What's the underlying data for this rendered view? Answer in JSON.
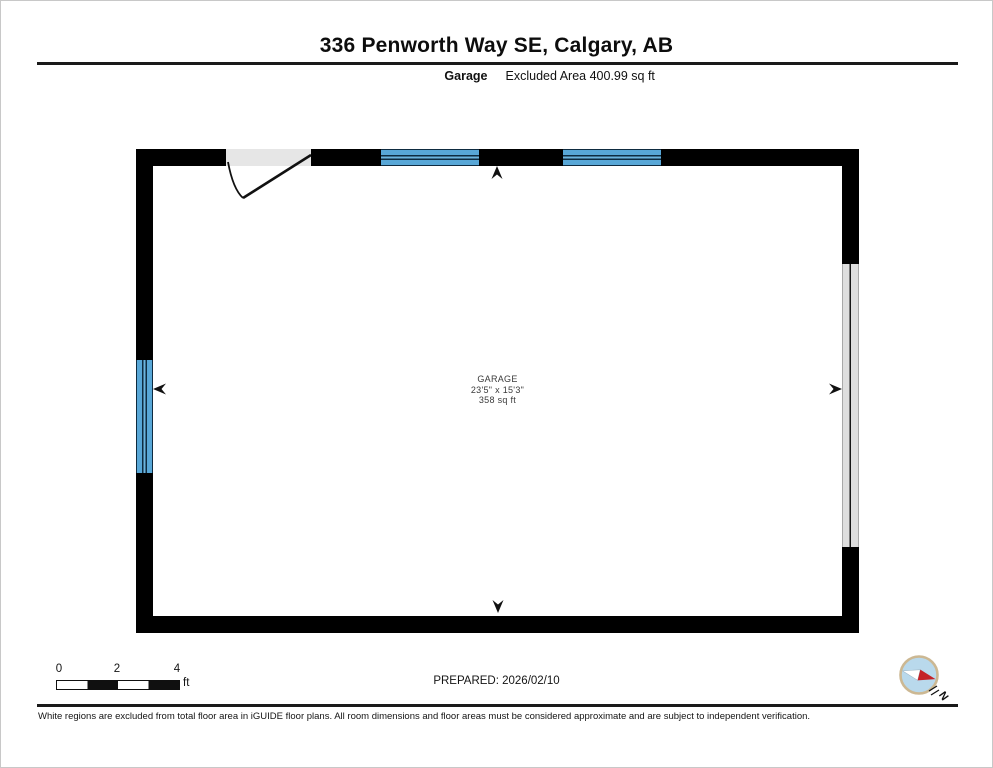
{
  "header": {
    "title": "336 Penworth Way SE, Calgary, AB",
    "floor_label": "Garage",
    "excluded_area": "Excluded Area 400.99 sq ft"
  },
  "floorplan": {
    "room": {
      "name": "GARAGE",
      "dimensions": "23'5\" x 15'3\"",
      "area": "358 sq ft"
    },
    "features": [
      "entry-door-swing",
      "window-top-left",
      "window-top-right",
      "window-left-wall",
      "garage-door-right-wall",
      "camera-arrow-up",
      "camera-arrow-down",
      "camera-arrow-left",
      "camera-arrow-right"
    ],
    "colors": {
      "wall": "#000000",
      "window_fill": "#58a7d7",
      "window_line": "#0e2b40",
      "door_opening_fill": "#e6e6e6",
      "garage_door_fill": "#dedede"
    }
  },
  "footer": {
    "scale": {
      "ticks": [
        "0",
        "2",
        "4"
      ],
      "unit": "ft"
    },
    "prepared": "PREPARED: 2026/02/10",
    "compass_north": "N",
    "disclaimer": "White regions are excluded from total floor area in iGUIDE floor plans. All room dimensions and floor areas must be considered approximate and are subject to independent verification."
  }
}
